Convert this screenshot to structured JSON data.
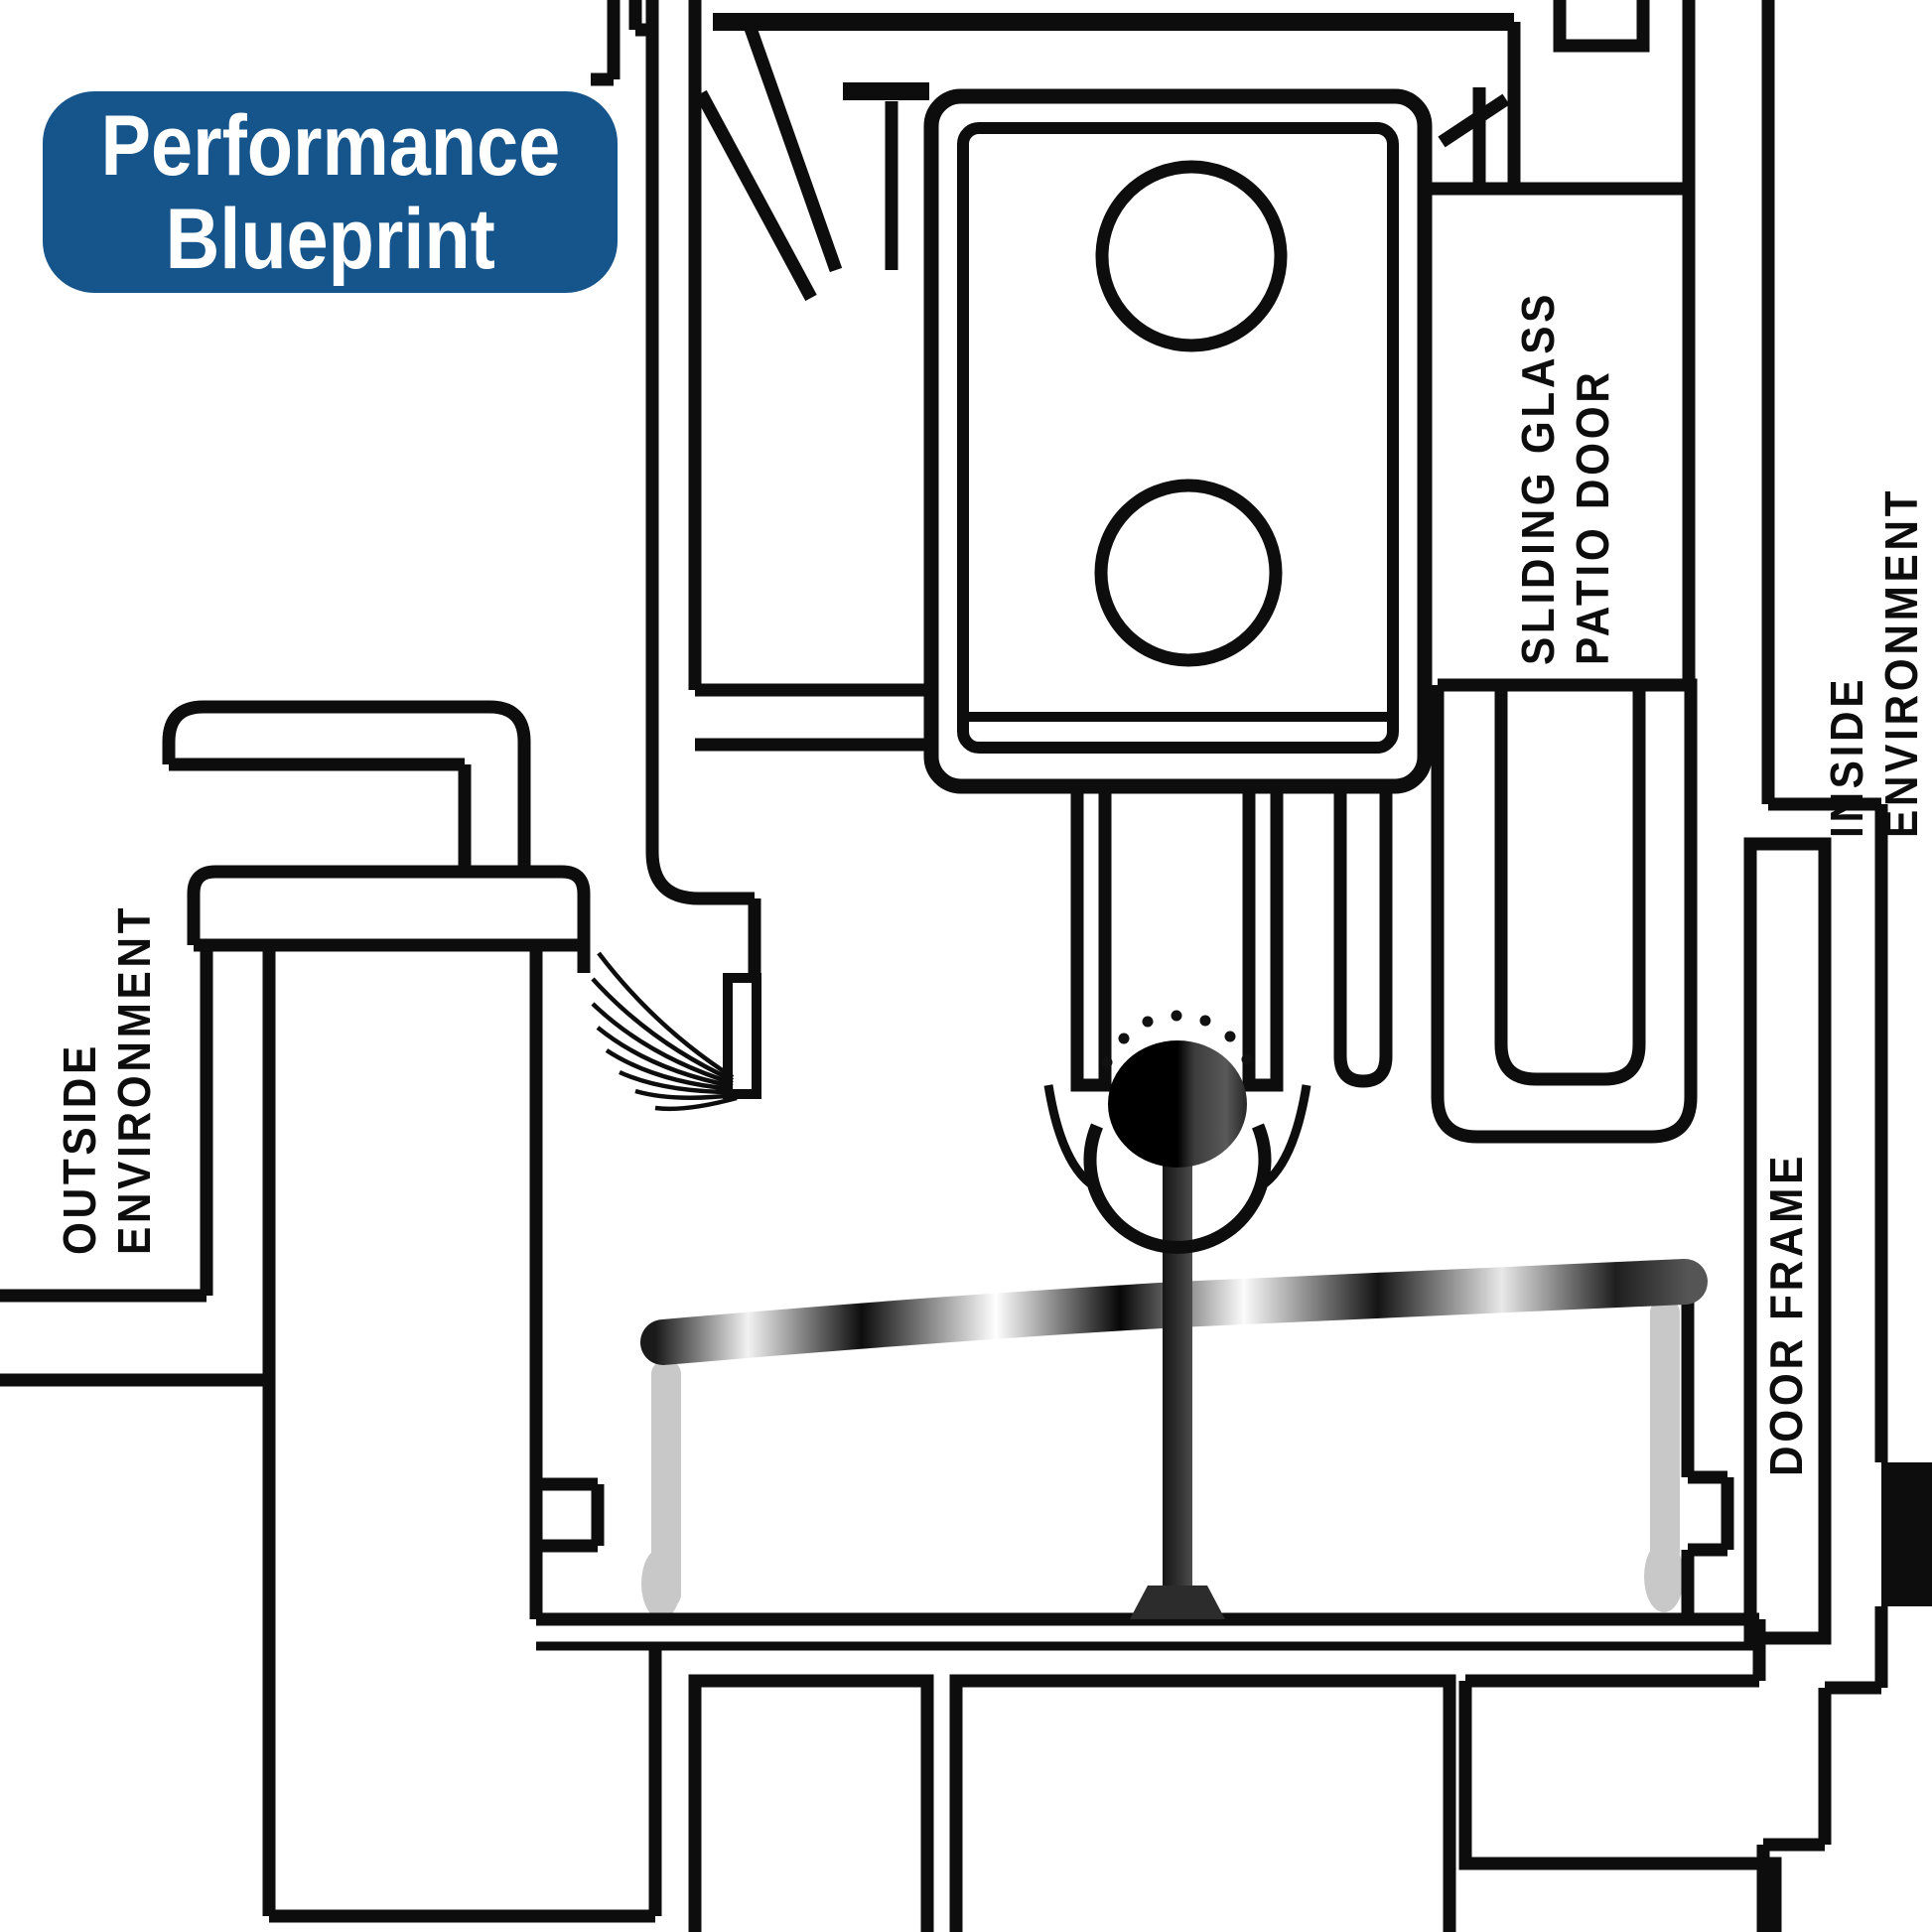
{
  "badge": {
    "lines": [
      "Performance",
      "Blueprint"
    ],
    "bg": "#15558C",
    "text_color": "#ffffff"
  },
  "labels": {
    "sliding_glass_patio_door": {
      "lines": [
        "SLIDING GLASS",
        "PATIO DOOR"
      ]
    },
    "inside_environment": {
      "lines": [
        "INSIDE",
        "ENVIRONMENT"
      ]
    },
    "outside_environment": {
      "lines": [
        "OUTSIDE",
        "ENVIRONMENT"
      ]
    },
    "door_frame": {
      "lines": [
        "DOOR FRAME"
      ]
    }
  },
  "diagram": {
    "line_color": "#0d0d0d",
    "shade_gray": "#c8c8c8",
    "background": "#ffffff",
    "parts": [
      "door frame head",
      "sliding glass patio door panel",
      "screw bosses",
      "insulated glass panes",
      "roller wheel with bearing",
      "stainless track cap",
      "sill chamber",
      "brush weatherstrip",
      "interlock pocket",
      "door frame jamb",
      "end cap"
    ]
  }
}
